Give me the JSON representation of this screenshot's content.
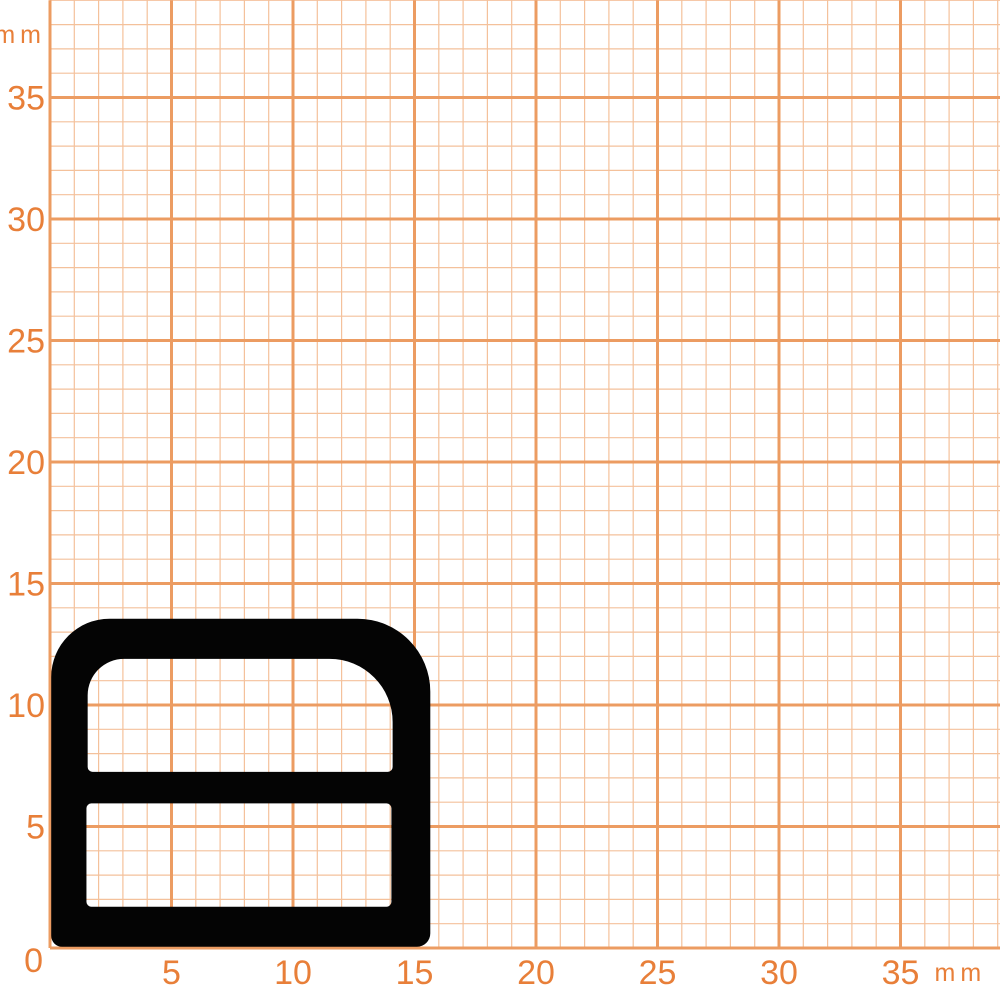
{
  "paper": {
    "background_color": "#ffffff",
    "grid": {
      "origin_px": {
        "x": 50,
        "y": 948
      },
      "mm_px": 24.3,
      "minor_step_mm": 1,
      "major_step_mm": 5,
      "minor_count": 39,
      "minor_color": "#f4c19b",
      "major_color": "#ec9c62",
      "minor_width": 1.2,
      "major_width": 3
    },
    "axes": {
      "x_tick_labels": [
        "5",
        "10",
        "15",
        "20",
        "25",
        "30",
        "35"
      ],
      "x_tick_values_mm": [
        5,
        10,
        15,
        20,
        25,
        30,
        35
      ],
      "y_tick_labels": [
        "35",
        "30",
        "25",
        "20",
        "15",
        "10",
        "5"
      ],
      "y_tick_values_mm": [
        35,
        30,
        25,
        20,
        15,
        10,
        5
      ],
      "origin_label": "0",
      "x_unit_label": "mm",
      "y_unit_label": "mm",
      "label_color": "#e87f39"
    }
  },
  "profile": {
    "description": "black seal profile cross-section",
    "fill_color": "#040404",
    "outer_mm": {
      "x1": 0.05,
      "y1": 0.05,
      "x2": 15.65,
      "y2": 13.55,
      "r_tl": 2.4,
      "r_tr": 3.0,
      "r_bl": 0.45,
      "r_br": 0.55
    },
    "upper_cavity_mm": {
      "x1": 1.55,
      "y1": 7.25,
      "x2": 14.1,
      "y2": 11.9,
      "r_tl": 1.5,
      "r_tr": 2.6,
      "r_bl": 0.2,
      "r_br": 0.2
    },
    "lower_cavity_mm": {
      "x1": 1.5,
      "y1": 1.7,
      "x2": 14.05,
      "y2": 5.95,
      "r_tl": 0.2,
      "r_tr": 0.2,
      "r_bl": 0.2,
      "r_br": 0.2
    }
  }
}
